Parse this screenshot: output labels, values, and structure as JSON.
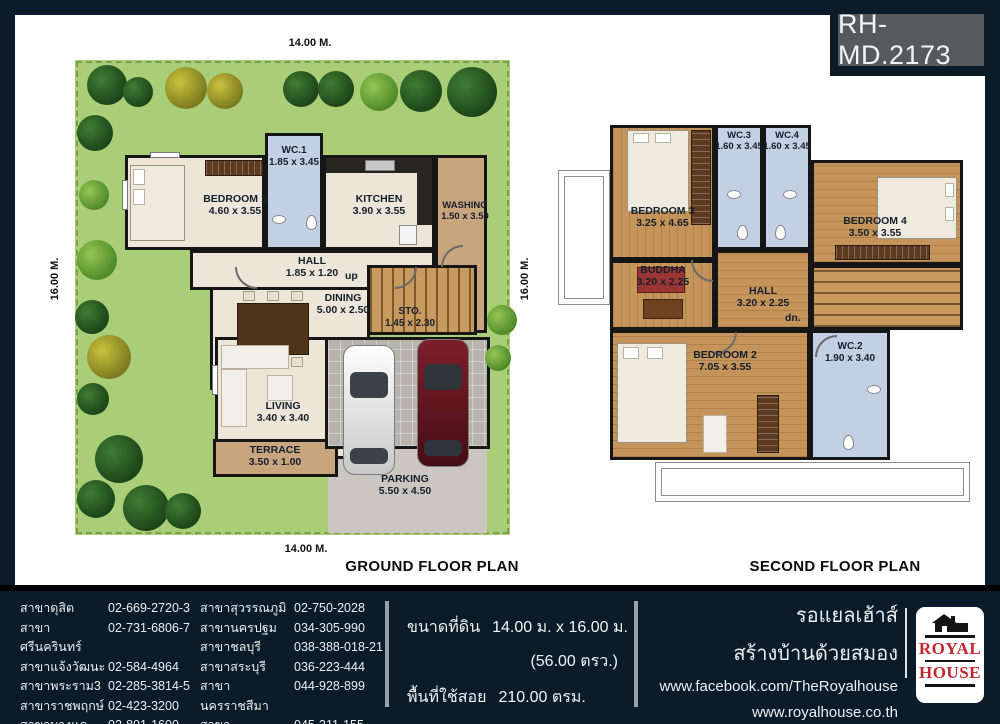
{
  "badge": "RH-MD.2173",
  "colors": {
    "frame_navy": "#0b1c28",
    "badge_gray": "#58595b",
    "logo_red": "#c2272d",
    "grass_green": "#a9ce77",
    "wood_floor": "#c5945a",
    "wc_blue": "#c3cfe3",
    "room_cream": "#ede6d8",
    "terrace_tan": "#c9a57e"
  },
  "ground": {
    "title": "GROUND FLOOR PLAN",
    "dims": {
      "top": "14.00 M.",
      "bottom": "14.00 M.",
      "left": "16.00 M.",
      "right": "16.00 M."
    },
    "up_label": "up",
    "rooms": {
      "bedroom1": {
        "name": "BEDROOM 1",
        "dims": "4.60 x 3.55"
      },
      "wc1": {
        "name": "WC.1",
        "dims": "1.85 x 3.45"
      },
      "kitchen": {
        "name": "KITCHEN",
        "dims": "3.90 x 3.55"
      },
      "washing": {
        "name": "WASHING",
        "dims": "1.50 x 3.50"
      },
      "hall": {
        "name": "HALL",
        "dims": "1.85 x 1.20"
      },
      "dining": {
        "name": "DINING",
        "dims": "5.00 x 2.50"
      },
      "sto": {
        "name": "STO.",
        "dims": "1.45 x 2.30"
      },
      "living": {
        "name": "LIVING",
        "dims": "3.40 x 3.40"
      },
      "terrace": {
        "name": "TERRACE",
        "dims": "3.50 x 1.00"
      },
      "parking": {
        "name": "PARKING",
        "dims": "5.50 x 4.50"
      }
    }
  },
  "second": {
    "title": "SECOND FLOOR PLAN",
    "dn_label": "dn.",
    "rooms": {
      "bedroom3": {
        "name": "BEDROOM 3",
        "dims": "3.25 x 4.65"
      },
      "wc3": {
        "name": "WC.3",
        "dims": "1.60 x 3.45"
      },
      "wc4": {
        "name": "WC.4",
        "dims": "1.60 x 3.45"
      },
      "bedroom4": {
        "name": "BEDROOM 4",
        "dims": "3.50 x 3.55"
      },
      "buddha": {
        "name": "BUDDHA",
        "dims": "3.20 x 2.25"
      },
      "hall": {
        "name": "HALL",
        "dims": "3.20 x 2.25"
      },
      "bedroom2": {
        "name": "BEDROOM 2",
        "dims": "7.05 x 3.55"
      },
      "wc2": {
        "name": "WC.2",
        "dims": "1.90 x 3.40"
      }
    }
  },
  "footer": {
    "branches_col1": [
      {
        "name": "สาขาดุสิต",
        "phone": "02-669-2720-3"
      },
      {
        "name": "สาขาศรีนครินทร์",
        "phone": "02-731-6806-7"
      },
      {
        "name": "สาขาแจ้งวัฒนะ",
        "phone": "02-584-4964"
      },
      {
        "name": "สาขาพระราม3",
        "phone": "02-285-3814-5"
      },
      {
        "name": "สาขาราชพฤกษ์",
        "phone": "02-423-3200"
      },
      {
        "name": "สาขาบางแค",
        "phone": "02-801-1600"
      }
    ],
    "branches_col2": [
      {
        "name": "สาขาสุวรรณภูมิ",
        "phone": "02-750-2028"
      },
      {
        "name": "สาขานครปฐม",
        "phone": "034-305-990"
      },
      {
        "name": "สาขาชลบุรี",
        "phone": "038-388-018-21"
      },
      {
        "name": "สาขาสระบุรี",
        "phone": "036-223-444"
      },
      {
        "name": "สาขานครราชสีมา",
        "phone": "044-928-899"
      },
      {
        "name": "สาขาอุบลราชธานี",
        "phone": "045-311-155"
      }
    ],
    "spec": {
      "label1": "ขนาดที่ดิน",
      "value1": "14.00 ม. x 16.00 ม.",
      "value2": "(56.00 ตรว.)",
      "label3": "พื้นที่ใช้สอย",
      "value3": "210.00 ตรม."
    },
    "brand": {
      "line1": "รอแยลเฮ้าส์",
      "line2": "สร้างบ้านด้วยสมอง",
      "facebook": "www.facebook.com/TheRoyalhouse",
      "website": "www.royalhouse.co.th"
    },
    "logo": {
      "top": "ROYAL",
      "bottom": "HOUSE"
    }
  }
}
